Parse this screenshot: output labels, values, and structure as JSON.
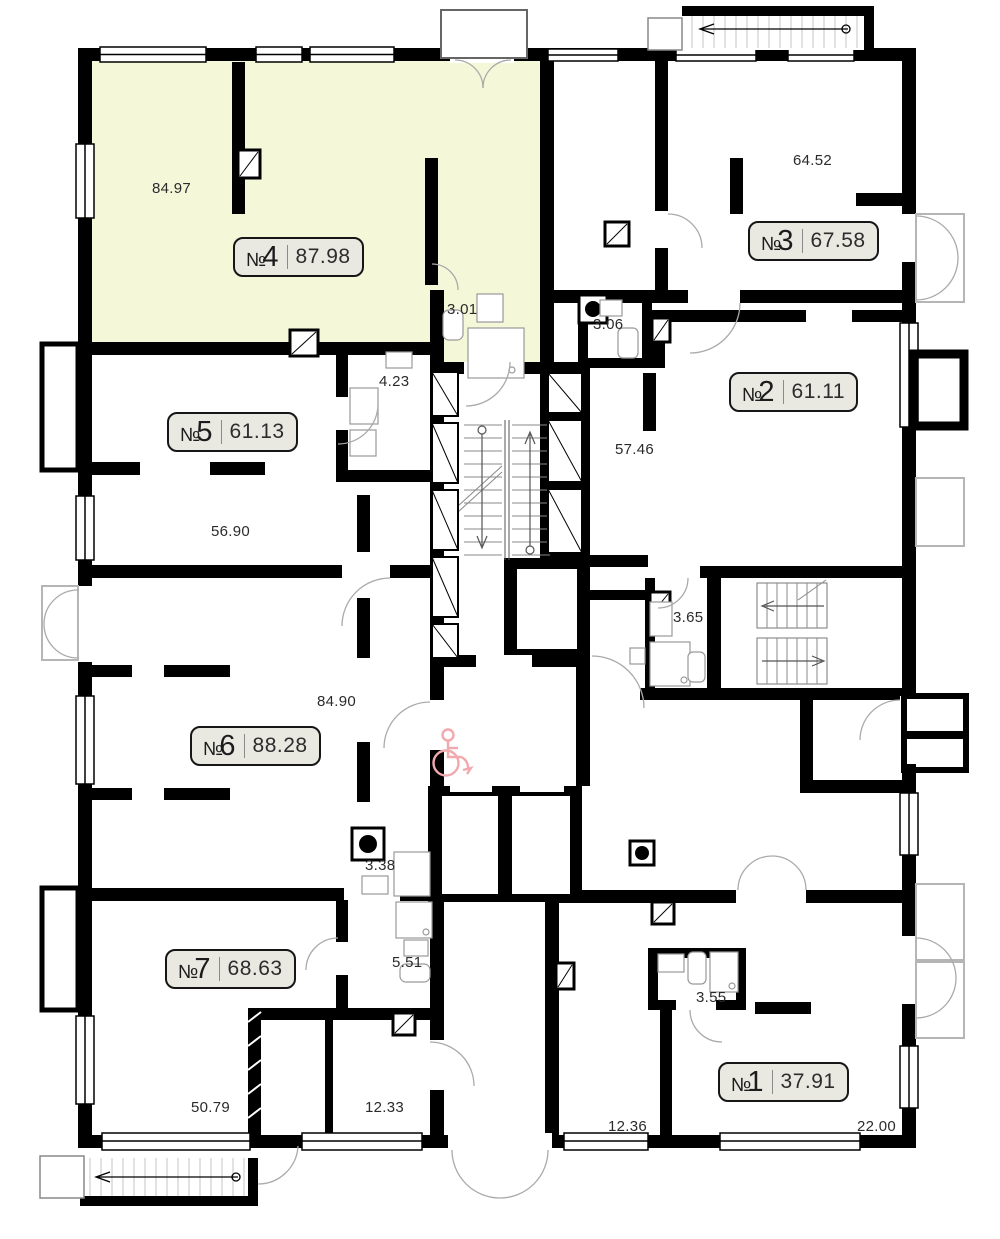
{
  "plan_title": "Floor plan with apartments 1-7",
  "colors": {
    "highlight_apartment_fill": "#f5f8d8",
    "wall": "#000000",
    "badge_background": "#e9e9e2",
    "accessibility_icon_pink": "#f2a9ad"
  },
  "icons": {
    "accessibility": "wheelchair-icon",
    "exit_arrows": "stair-direction-arrow"
  },
  "apartments": [
    {
      "prefix": "№",
      "digit": "1",
      "area": "37.91"
    },
    {
      "prefix": "№",
      "digit": "2",
      "area": "61.11"
    },
    {
      "prefix": "№",
      "digit": "3",
      "area": "67.58"
    },
    {
      "prefix": "№",
      "digit": "4",
      "area": "87.98"
    },
    {
      "prefix": "№",
      "digit": "5",
      "area": "61.13"
    },
    {
      "prefix": "№",
      "digit": "6",
      "area": "88.28"
    },
    {
      "prefix": "№",
      "digit": "7",
      "area": "68.63"
    }
  ],
  "room_areas": [
    "84.97",
    "64.52",
    "3.01",
    "3.06",
    "4.23",
    "57.46",
    "56.90",
    "3.65",
    "84.90",
    "3.38",
    "5.51",
    "3.55",
    "50.79",
    "12.33",
    "12.36",
    "22.00"
  ]
}
